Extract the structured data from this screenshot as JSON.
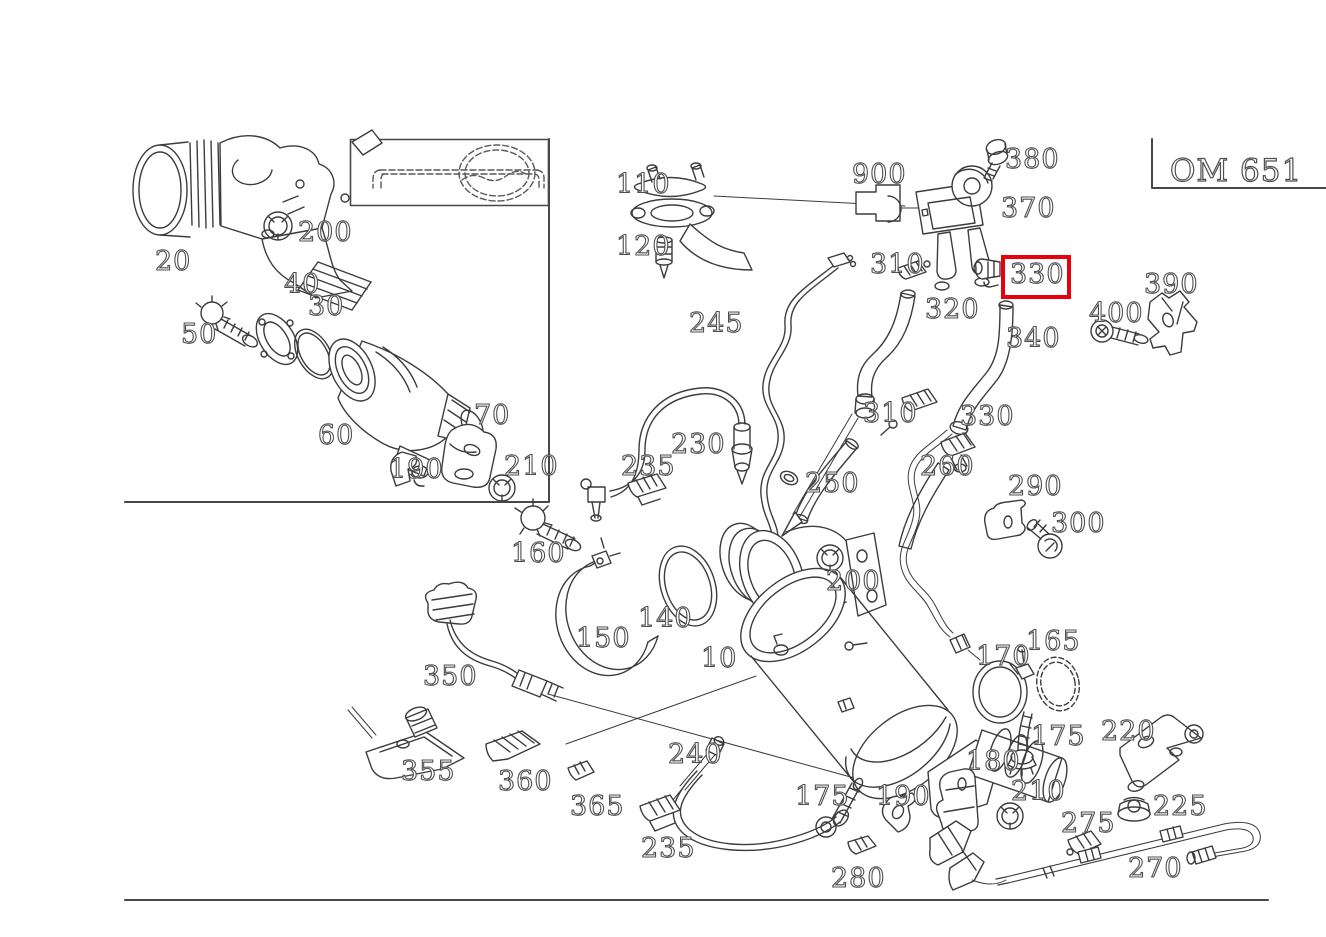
{
  "engine_code": "OM 651",
  "colors": {
    "background": "#ffffff",
    "line": "#3c3c3c",
    "label_outline": "#4f4f4f",
    "highlight": "#e8000d"
  },
  "highlight": {
    "label": "330",
    "x": 1001,
    "y": 255,
    "width": 62,
    "height": 36
  },
  "labels": [
    {
      "text": "20",
      "x": 155,
      "y": 270
    },
    {
      "text": "200",
      "x": 298,
      "y": 241
    },
    {
      "text": "40",
      "x": 284,
      "y": 293
    },
    {
      "text": "30",
      "x": 308,
      "y": 315
    },
    {
      "text": "50",
      "x": 181,
      "y": 343
    },
    {
      "text": "60",
      "x": 318,
      "y": 444
    },
    {
      "text": "70",
      "x": 474,
      "y": 424
    },
    {
      "text": "190",
      "x": 389,
      "y": 478
    },
    {
      "text": "210",
      "x": 504,
      "y": 475
    },
    {
      "text": "110",
      "x": 616,
      "y": 193
    },
    {
      "text": "120",
      "x": 616,
      "y": 255
    },
    {
      "text": "900",
      "x": 852,
      "y": 183
    },
    {
      "text": "380",
      "x": 1005,
      "y": 168
    },
    {
      "text": "370",
      "x": 1001,
      "y": 217
    },
    {
      "text": "310",
      "x": 870,
      "y": 273
    },
    {
      "text": "330",
      "x": 1010,
      "y": 283,
      "highlighted": true
    },
    {
      "text": "390",
      "x": 1144,
      "y": 293
    },
    {
      "text": "400",
      "x": 1089,
      "y": 322
    },
    {
      "text": "320",
      "x": 925,
      "y": 318
    },
    {
      "text": "340",
      "x": 1006,
      "y": 347
    },
    {
      "text": "245",
      "x": 689,
      "y": 332
    },
    {
      "text": "310",
      "x": 863,
      "y": 422
    },
    {
      "text": "330",
      "x": 960,
      "y": 425
    },
    {
      "text": "260",
      "x": 920,
      "y": 475
    },
    {
      "text": "290",
      "x": 1008,
      "y": 495
    },
    {
      "text": "300",
      "x": 1051,
      "y": 532
    },
    {
      "text": "230",
      "x": 671,
      "y": 453
    },
    {
      "text": "235",
      "x": 621,
      "y": 475
    },
    {
      "text": "250",
      "x": 805,
      "y": 492
    },
    {
      "text": "160",
      "x": 511,
      "y": 562
    },
    {
      "text": "150",
      "x": 576,
      "y": 647
    },
    {
      "text": "140",
      "x": 638,
      "y": 627
    },
    {
      "text": "10",
      "x": 701,
      "y": 667
    },
    {
      "text": "200",
      "x": 826,
      "y": 590
    },
    {
      "text": "165",
      "x": 1026,
      "y": 650
    },
    {
      "text": "170",
      "x": 976,
      "y": 665
    },
    {
      "text": "175",
      "x": 1031,
      "y": 745
    },
    {
      "text": "220",
      "x": 1101,
      "y": 740
    },
    {
      "text": "180",
      "x": 966,
      "y": 770
    },
    {
      "text": "210",
      "x": 1011,
      "y": 800
    },
    {
      "text": "225",
      "x": 1153,
      "y": 815
    },
    {
      "text": "275",
      "x": 1061,
      "y": 832
    },
    {
      "text": "270",
      "x": 1128,
      "y": 877
    },
    {
      "text": "350",
      "x": 423,
      "y": 685
    },
    {
      "text": "355",
      "x": 401,
      "y": 780
    },
    {
      "text": "360",
      "x": 498,
      "y": 790
    },
    {
      "text": "365",
      "x": 570,
      "y": 815
    },
    {
      "text": "240",
      "x": 668,
      "y": 763
    },
    {
      "text": "235",
      "x": 641,
      "y": 857
    },
    {
      "text": "175",
      "x": 795,
      "y": 805
    },
    {
      "text": "190",
      "x": 876,
      "y": 805
    },
    {
      "text": "280",
      "x": 831,
      "y": 887
    }
  ]
}
